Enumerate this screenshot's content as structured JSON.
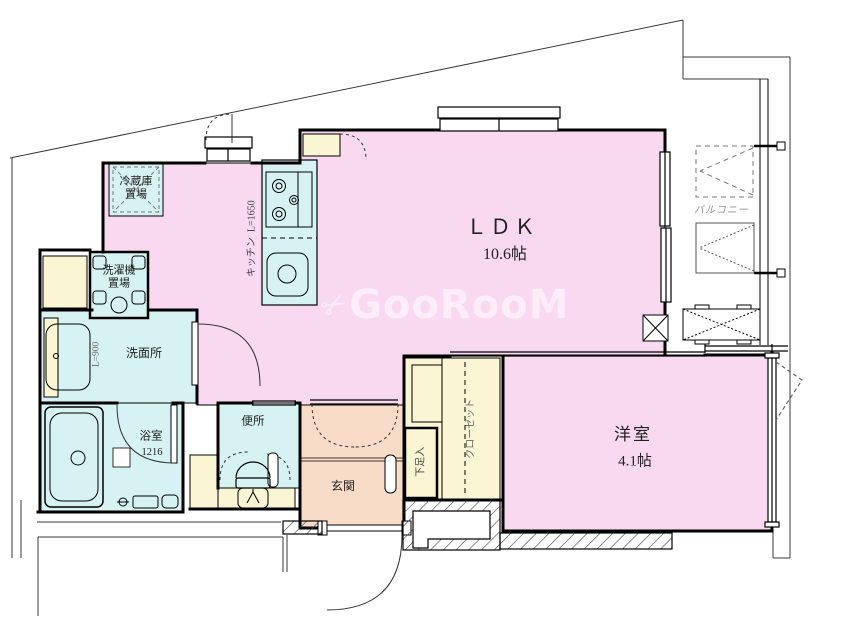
{
  "watermark": {
    "text": "GooRooM",
    "icon": "scissors-icon"
  },
  "rooms": {
    "ldk": {
      "name": "ＬＤＫ",
      "size": "10.6帖"
    },
    "western_room": {
      "name": "洋室",
      "size": "4.1帖"
    },
    "entrance": {
      "name": "玄関"
    },
    "washroom": {
      "name": "洗面所"
    },
    "bathroom": {
      "name": "浴室",
      "size": "1216"
    },
    "toilet": {
      "name": "便所"
    },
    "balcony": {
      "name": "バルコニー"
    }
  },
  "equipment": {
    "refrigerator_space": {
      "line1": "冷蔵庫",
      "line2": "置場"
    },
    "washer_space": {
      "line1": "洗濯機",
      "line2": "置場"
    },
    "kitchen": {
      "name": "キッチン",
      "length": "L=1650"
    },
    "vanity": {
      "length": "L=900"
    },
    "closet": {
      "name": "クローゼット"
    },
    "shoe_box": {
      "name": "下足入"
    }
  },
  "colors": {
    "room_pink": "#F9D9F0",
    "room_salmon": "#F9DCC8",
    "room_cyan": "#D7F2F2",
    "room_cream": "#FAF5D2",
    "line": "#1A1A1A",
    "balcony_text": "#929292",
    "watermark": "#FFFFFF"
  }
}
